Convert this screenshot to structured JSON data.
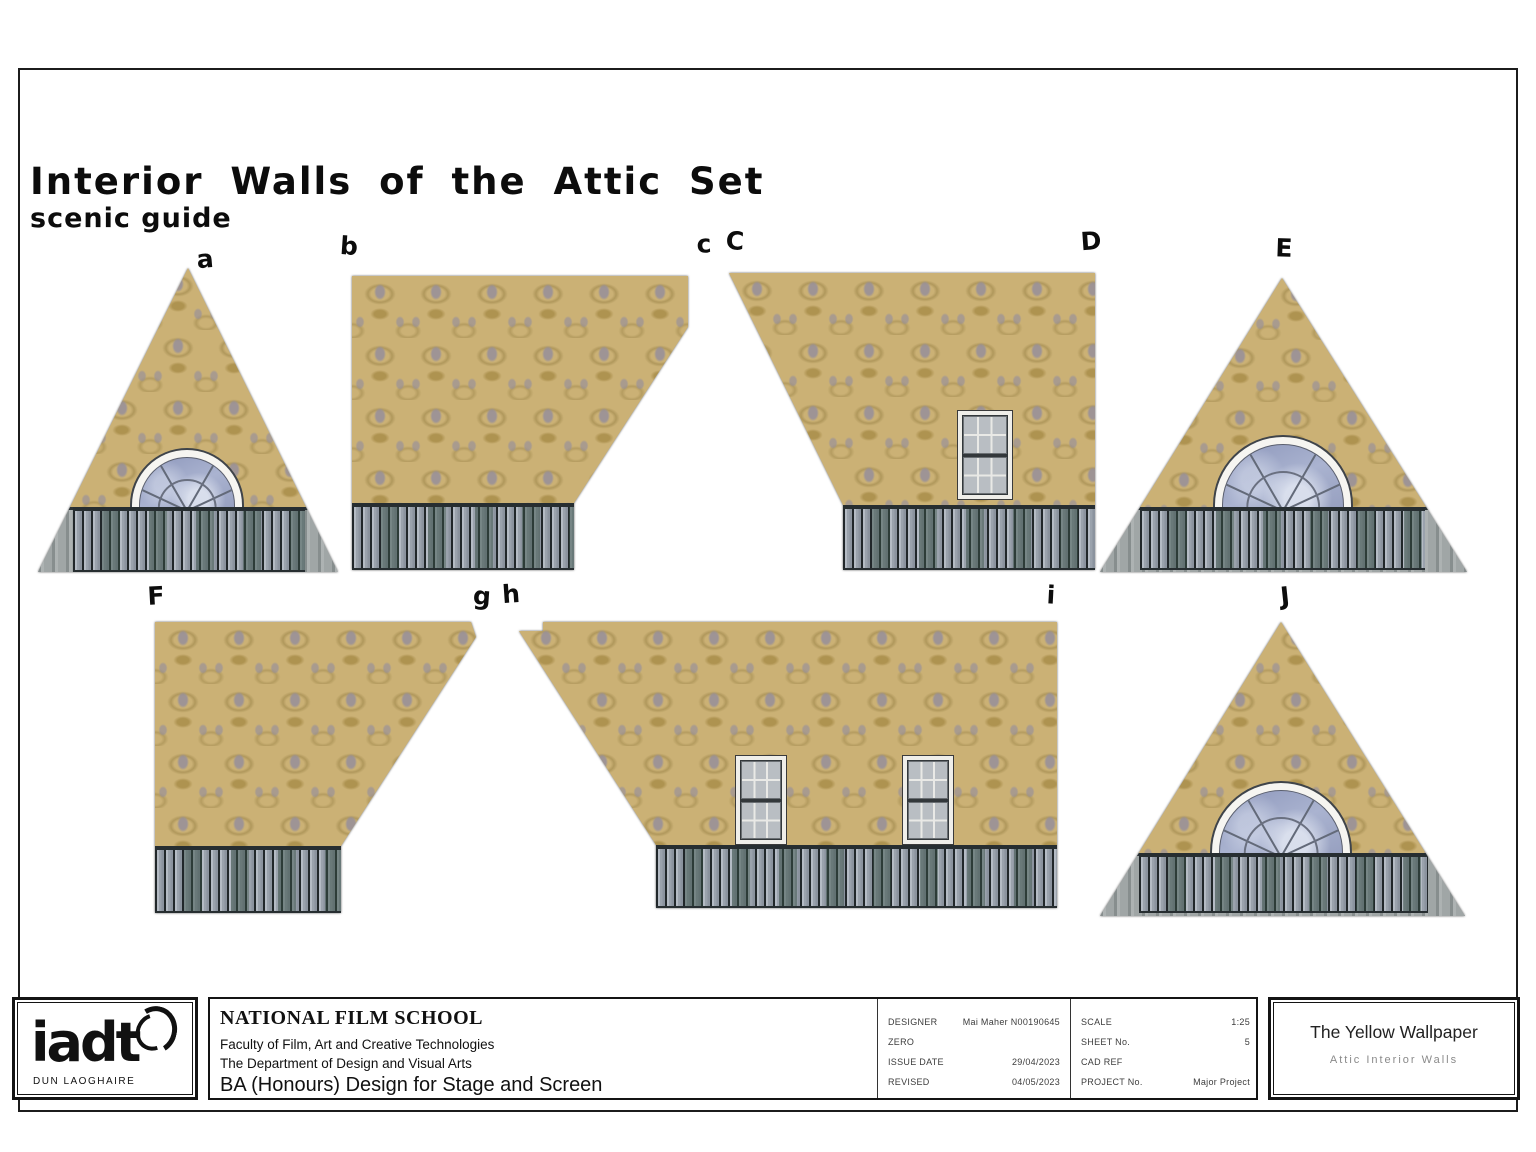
{
  "sheet": {
    "title_line1": "Interior Walls of the Attic Set",
    "title_line2": "scenic guide"
  },
  "wall_labels": [
    "a",
    "b",
    "c",
    "C",
    "D",
    "E",
    "F",
    "g",
    "h",
    "i",
    "J"
  ],
  "title_block": {
    "logo_text": "iadt",
    "logo_subtext": "DUN LAOGHAIRE",
    "school_name": "NATIONAL FILM SCHOOL",
    "faculty": "Faculty of Film, Art and Creative Technologies",
    "department": "The Department of Design and Visual Arts",
    "course": "BA (Honours) Design for Stage and Screen",
    "fields": {
      "designer_label": "DESIGNER",
      "designer_value": "Mai Maher N00190645",
      "zero_label": "ZERO",
      "zero_value": "",
      "issue_date_label": "ISSUE DATE",
      "issue_date_value": "29/04/2023",
      "revised_label": "REVISED",
      "revised_value": "04/05/2023",
      "scale_label": "SCALE",
      "scale_value": "1:25",
      "sheet_no_label": "SHEET No.",
      "sheet_no_value": "5",
      "cad_ref_label": "CAD REF",
      "cad_ref_value": "",
      "project_no_label": "PROJECT No.",
      "project_no_value": "Major Project"
    },
    "project_title": "The Yellow Wallpaper",
    "project_subtitle": "Attic Interior Walls"
  },
  "colors": {
    "wallpaper_base": "#cbb175",
    "wallpaper_motif": "#968fa0",
    "wainscot_plank_light": "#9aa2ac",
    "wainscot_plank_dark": "#46584f",
    "glass_blue": "#9aa4c6",
    "ink": "#111111"
  }
}
